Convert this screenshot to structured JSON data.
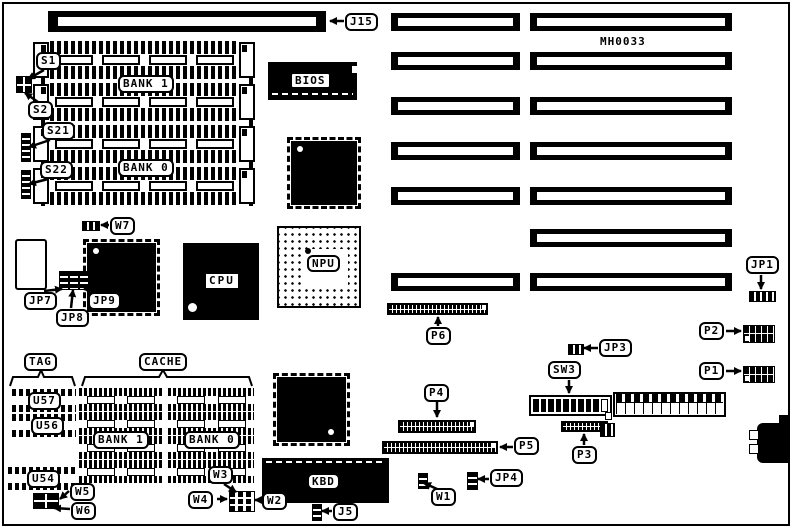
{
  "diagram": {
    "part_number": "MH0033",
    "memory": {
      "connector": "J15",
      "switch_s1": "S1",
      "switch_s2": "S2",
      "switch_s21": "S21",
      "switch_s22": "S22",
      "bank1": "BANK 1",
      "bank0": "BANK 0",
      "jumper_w7": "W7"
    },
    "chips": {
      "bios": "BIOS",
      "cpu": "CPU",
      "npu": "NPU",
      "kbd": "KBD"
    },
    "jumpers": {
      "jp1": "JP1",
      "jp3": "JP3",
      "jp4": "JP4",
      "jp7": "JP7",
      "jp8": "JP8",
      "jp9": "JP9",
      "w1": "W1",
      "w2": "W2",
      "w3": "W3",
      "w4": "W4",
      "w5": "W5",
      "w6": "W6",
      "j5": "J5"
    },
    "connectors": {
      "p1": "P1",
      "p2": "P2",
      "p3": "P3",
      "p4": "P4",
      "p5": "P5",
      "p6": "P6"
    },
    "switches": {
      "sw3": "SW3"
    },
    "cache": {
      "tag": "TAG",
      "cache": "CACHE",
      "u57": "U57",
      "u56": "U56",
      "u54": "U54",
      "bank1": "BANK 1",
      "bank0": "BANK 0"
    }
  }
}
